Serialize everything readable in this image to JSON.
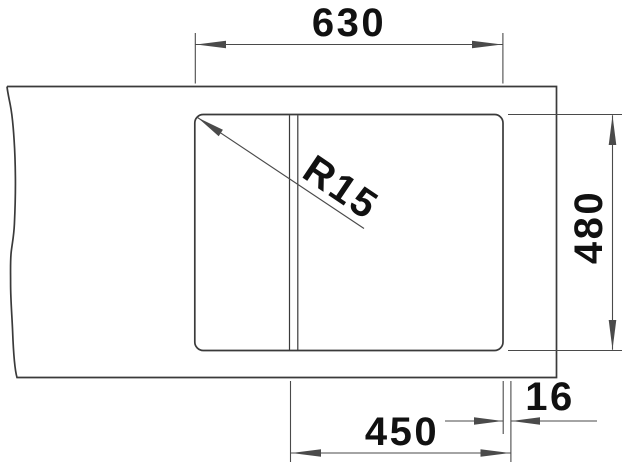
{
  "diagram": {
    "kind": "sink-cutout-dimension-drawing",
    "labels": {
      "top_width": "630",
      "height": "480",
      "bowl_width": "450",
      "edge_offset": "16",
      "corner_radius": "R15"
    },
    "colors": {
      "object_line": "#3a3a3a",
      "dimension_line": "#4a4a4a",
      "text": "#111111",
      "background": "#ffffff"
    }
  }
}
